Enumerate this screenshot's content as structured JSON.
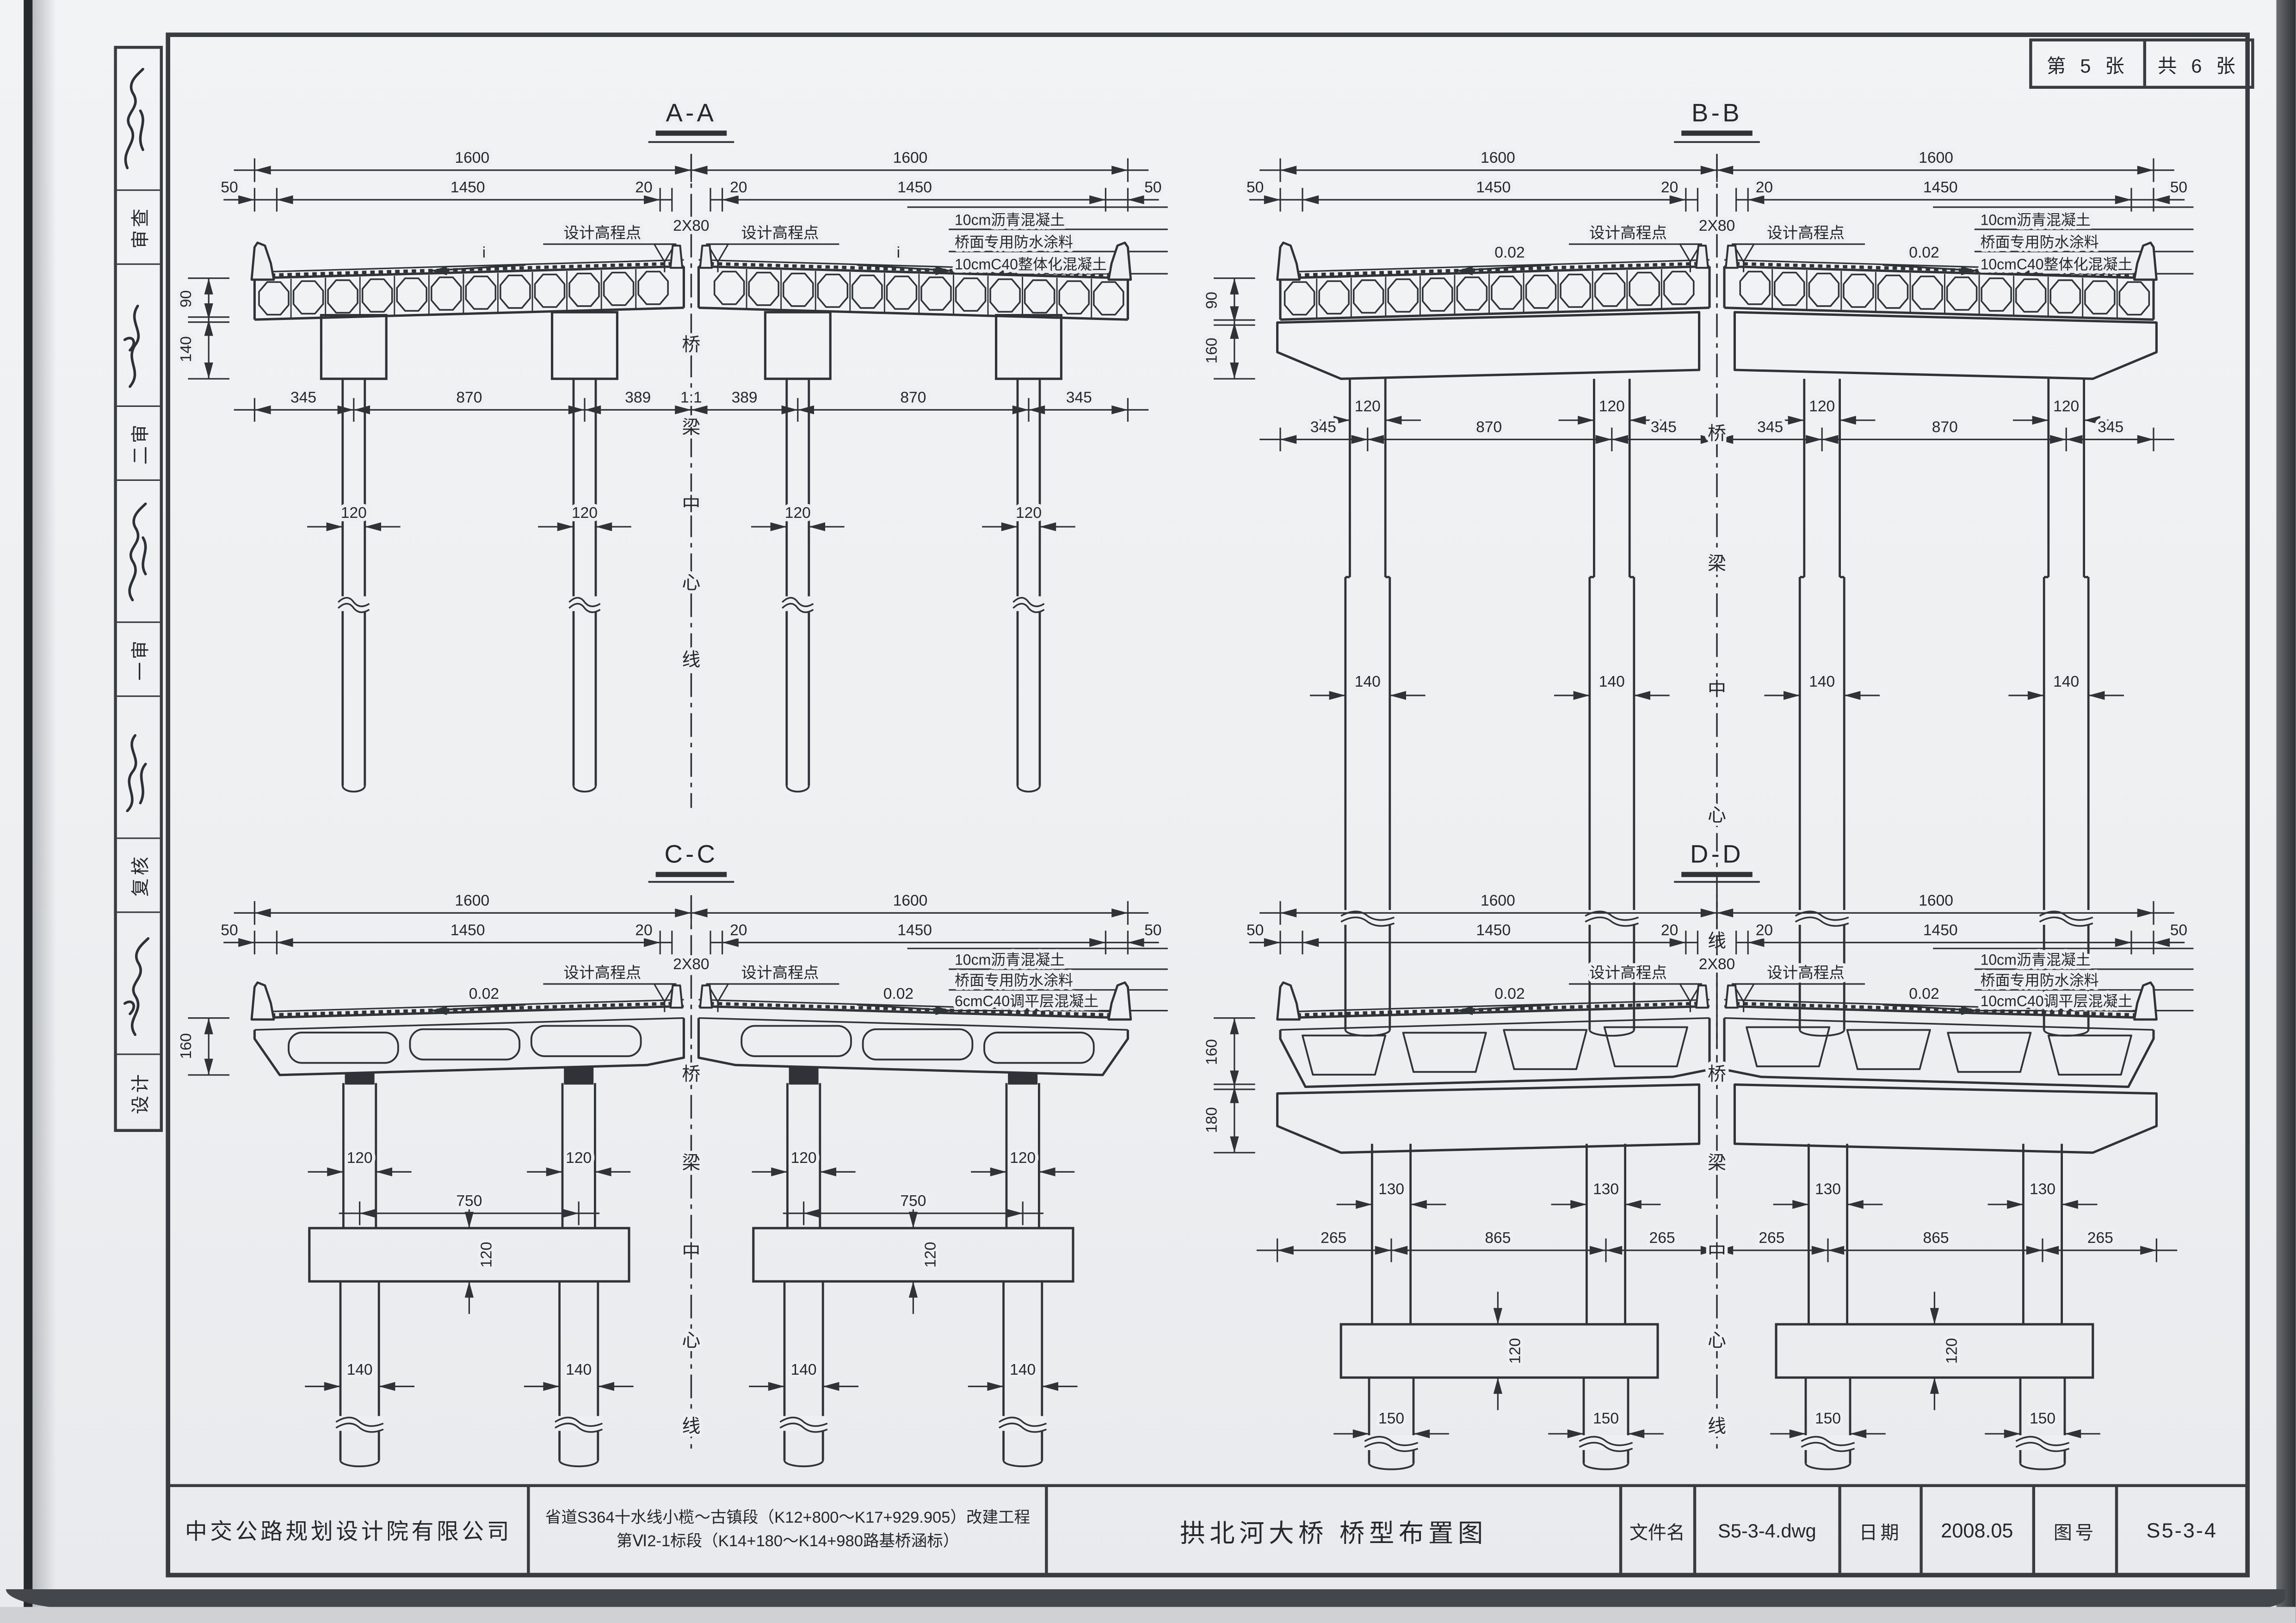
{
  "sheet_info": {
    "page_label": "第 5 张",
    "total_label": "共 6 张"
  },
  "signature_column": {
    "labels_top_to_bottom": [
      "审查",
      "二审",
      "一审",
      "复核",
      "设计"
    ]
  },
  "section_common": {
    "dim_1600": "1600",
    "dim_1450": "1450",
    "dim_20": "20",
    "dim_50": "50",
    "dim_2x80": "2X80",
    "elevation_label": "设计高程点",
    "centerline_chars": [
      "桥",
      "梁",
      "中",
      "心",
      "线"
    ]
  },
  "sections": {
    "aa": {
      "title": "A-A",
      "slope_label": "i",
      "notes": [
        "10cm沥青混凝土",
        "桥面专用防水涂料",
        "10cmC40整体化混凝土"
      ],
      "span_dims": [
        "345",
        "870",
        "389"
      ],
      "slope_ratio": "1:1",
      "pile_width": "120",
      "vertical_dims": [
        "90",
        "140"
      ]
    },
    "bb": {
      "title": "B-B",
      "slope_label": "0.02",
      "notes": [
        "10cm沥青混凝土",
        "桥面专用防水涂料",
        "10cmC40整体化混凝土"
      ],
      "span_dims": [
        "345",
        "870",
        "345"
      ],
      "column_width": "120",
      "pile_width": "140",
      "vertical_dims": [
        "90",
        "160"
      ]
    },
    "cc": {
      "title": "C-C",
      "slope_label": "0.02",
      "notes": [
        "10cm沥青混凝土",
        "桥面专用防水涂料",
        "6cmC40调平层混凝土"
      ],
      "column_width": "120",
      "column_spacing": "750",
      "tie_beam_height": "120",
      "pile_width": "140",
      "vertical_dims": [
        "160"
      ]
    },
    "dd": {
      "title": "D-D",
      "slope_label": "0.02",
      "notes": [
        "10cm沥青混凝土",
        "桥面专用防水涂料",
        "10cmC40调平层混凝土"
      ],
      "span_dims": [
        "265",
        "865",
        "265"
      ],
      "column_width": "130",
      "tie_beam_height": "120",
      "pile_width": "150",
      "vertical_dims": [
        "160",
        "180"
      ]
    }
  },
  "title_block": {
    "company": "中交公路规划设计院有限公司",
    "project_line1": "省道S364十水线小榄～古镇段（K12+800～K17+929.905）改建工程",
    "project_line2": "第Ⅵ2-1标段（K14+180～K14+980路基桥涵标）",
    "drawing_title": "拱北河大桥 桥型布置图",
    "file_label": "文件名",
    "file_value": "S5-3-4.dwg",
    "date_label": "日期",
    "date_value": "2008.05",
    "number_label": "图号",
    "number_value": "S5-3-4"
  }
}
